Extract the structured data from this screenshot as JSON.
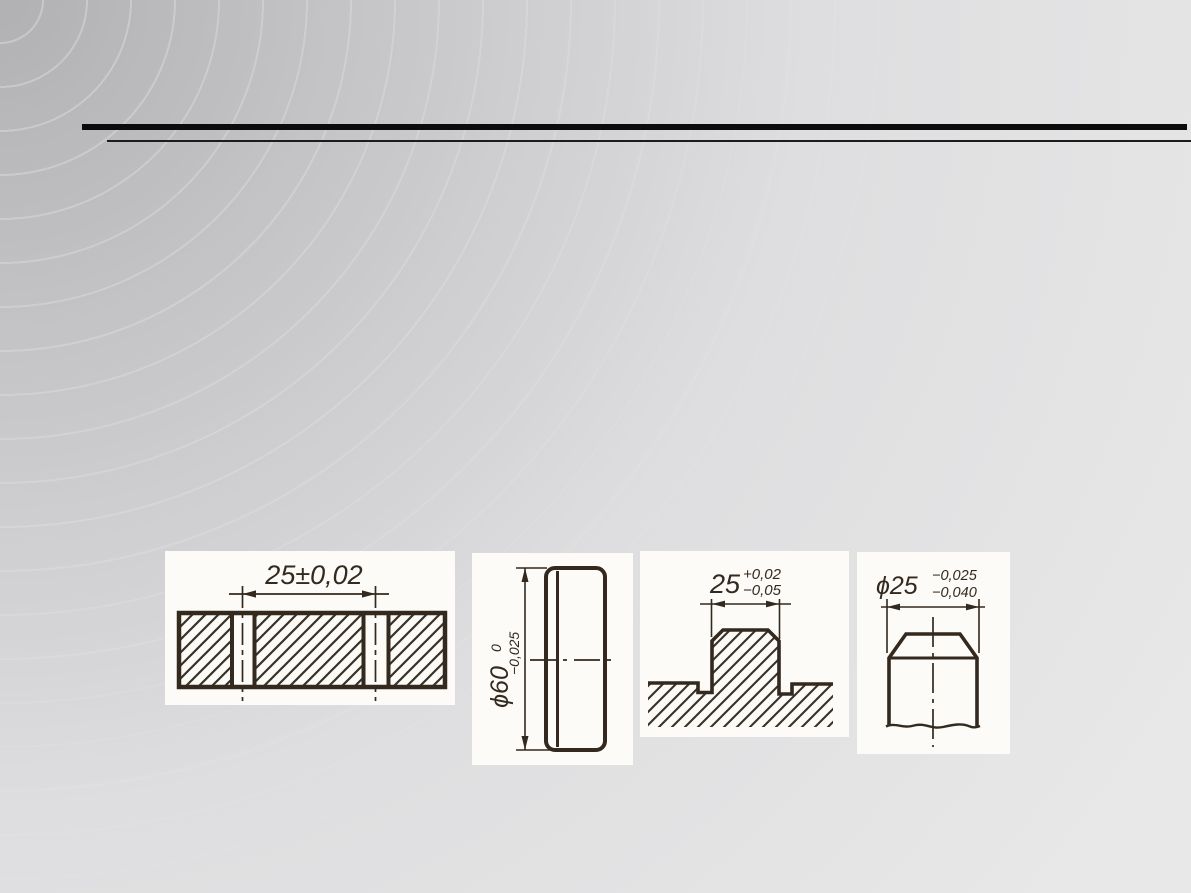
{
  "slide": {
    "theme": {
      "background_corner": "#b1b1b4",
      "background_edge": "#e8e8e8",
      "rule_thick_color": "#0b0b0b",
      "rule_thin_color": "#1c1c1c",
      "drawing_ink": "#33291e",
      "panel_background": "#fcfbf7"
    },
    "figures": [
      {
        "name": "slotted-shaft-section",
        "dimension": "25±0,02"
      },
      {
        "name": "disc-side-view",
        "dimension": "ϕ60",
        "tol_upper": "0",
        "tol_lower": "−0,025"
      },
      {
        "name": "boss-profile-section",
        "dimension": "25",
        "tol_upper": "+0,02",
        "tol_lower": "−0,05"
      },
      {
        "name": "shaft-end-view",
        "dimension": "ϕ25",
        "tol_upper": "−0,025",
        "tol_lower": "−0,040"
      }
    ]
  }
}
